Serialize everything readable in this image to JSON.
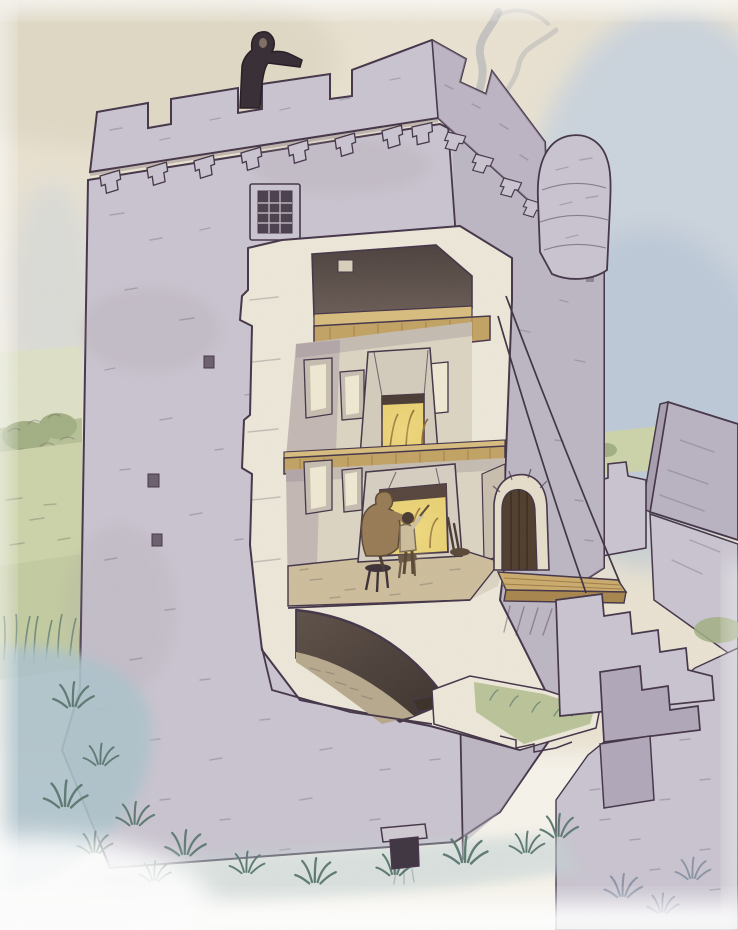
{
  "scene": {
    "type": "cutaway-reconstruction-illustration",
    "subject": "medieval tower house cross-section",
    "medium": "ink and watercolor",
    "elements": [
      "crenellated-parapet",
      "watchman-figure",
      "chimney-smoke",
      "corner-turret",
      "machicolation-corbels",
      "barred-window",
      "putlog-holes",
      "attic-chamber",
      "timber-loft-floor",
      "upper-chamber",
      "chamber-window",
      "chamber-fireplace",
      "great-hall",
      "hall-fireplace",
      "seated-adult-figure",
      "child-figure",
      "fire-tools",
      "barrel-vaulted-basement",
      "floor-hatch",
      "arched-entrance-door",
      "drawbridge",
      "drawbridge-ropes",
      "external-stone-steps",
      "gabled-outbuilding",
      "courtyard-wall",
      "hedged-fields",
      "marsh-water",
      "reed-tufts",
      "drain-outlet"
    ]
  },
  "palette": {
    "paper": "#e9e2d1",
    "paper-deep": "#ddd6c2",
    "paper-edge": "#f6f3ea",
    "sky-blue": "#c6d1de",
    "sky-blue2": "#b0c1d4",
    "stone": "#c9c4cf",
    "stone-mid": "#b0a8b8",
    "stone-dark": "#948ba0",
    "ink": "#443548",
    "cut": "#ece7d8",
    "cream": "#dcd4c1",
    "cream-bright": "#efe8d2",
    "mauve": "#a89aa6",
    "attic": "#564a44",
    "wood": "#c2a364",
    "wood-light": "#d8bc7e",
    "wood-dark": "#9e7c46",
    "fire": "#e9d173",
    "fire-deep": "#c98f3a",
    "green": "#ccd2a8",
    "green2": "#b6c096",
    "hedge": "#a2af83",
    "reed": "#5d7a72",
    "water": "#adc3cb",
    "door": "#4f3d2c",
    "smoke": "#a6aab0",
    "tunic": "#977b55",
    "figure-dark": "#362c33",
    "floor-tan": "#cdbd9b"
  }
}
